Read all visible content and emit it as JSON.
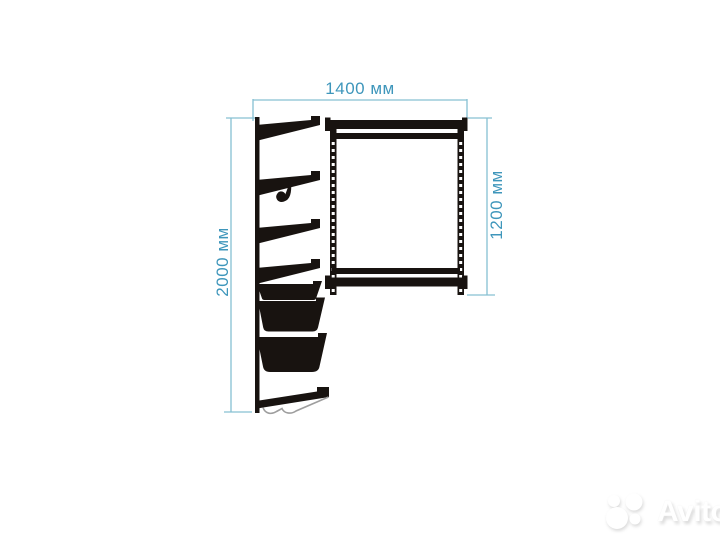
{
  "diagram": {
    "type": "technical-drawing",
    "subject": "wall-mounted-garment-rack-side-and-front-view",
    "labels": {
      "width": "1400 мм",
      "height_total": "2000 мм",
      "height_frame": "1200 мм"
    },
    "dimensions_mm": {
      "width": 1400,
      "height_total": 2000,
      "height_frame": 1200
    },
    "colors": {
      "dim-line": "#86c0d2",
      "dim-text": "#3e96bb",
      "ink": "#181310",
      "wire": "#9e9e9e",
      "background": "#ffffff",
      "watermark": "#ffffff",
      "watermark-shadow": "#dadada"
    }
  },
  "watermark": {
    "brand": "Avito"
  }
}
